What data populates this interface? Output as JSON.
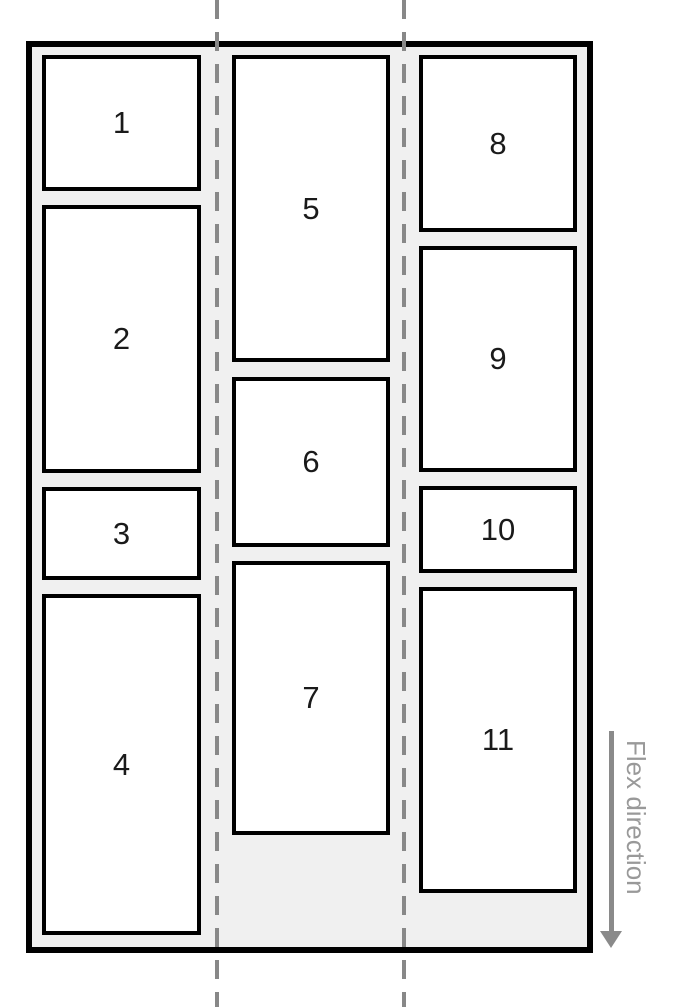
{
  "diagram": {
    "boxes": [
      {
        "label": "1"
      },
      {
        "label": "2"
      },
      {
        "label": "3"
      },
      {
        "label": "4"
      },
      {
        "label": "5"
      },
      {
        "label": "6"
      },
      {
        "label": "7"
      },
      {
        "label": "8"
      },
      {
        "label": "9"
      },
      {
        "label": "10"
      },
      {
        "label": "11"
      }
    ],
    "flex_direction_label": "Flex direction",
    "colors": {
      "container_background": "#f0f0f0",
      "container_border": "#000000",
      "box_background": "#ffffff",
      "box_border": "#000000",
      "number_text": "#1a1a1a",
      "dashed_guide_line": "#888888",
      "arrow": "#8a8a8a",
      "flex_direction_text": "#999999",
      "page_background": "#ffffff"
    }
  }
}
